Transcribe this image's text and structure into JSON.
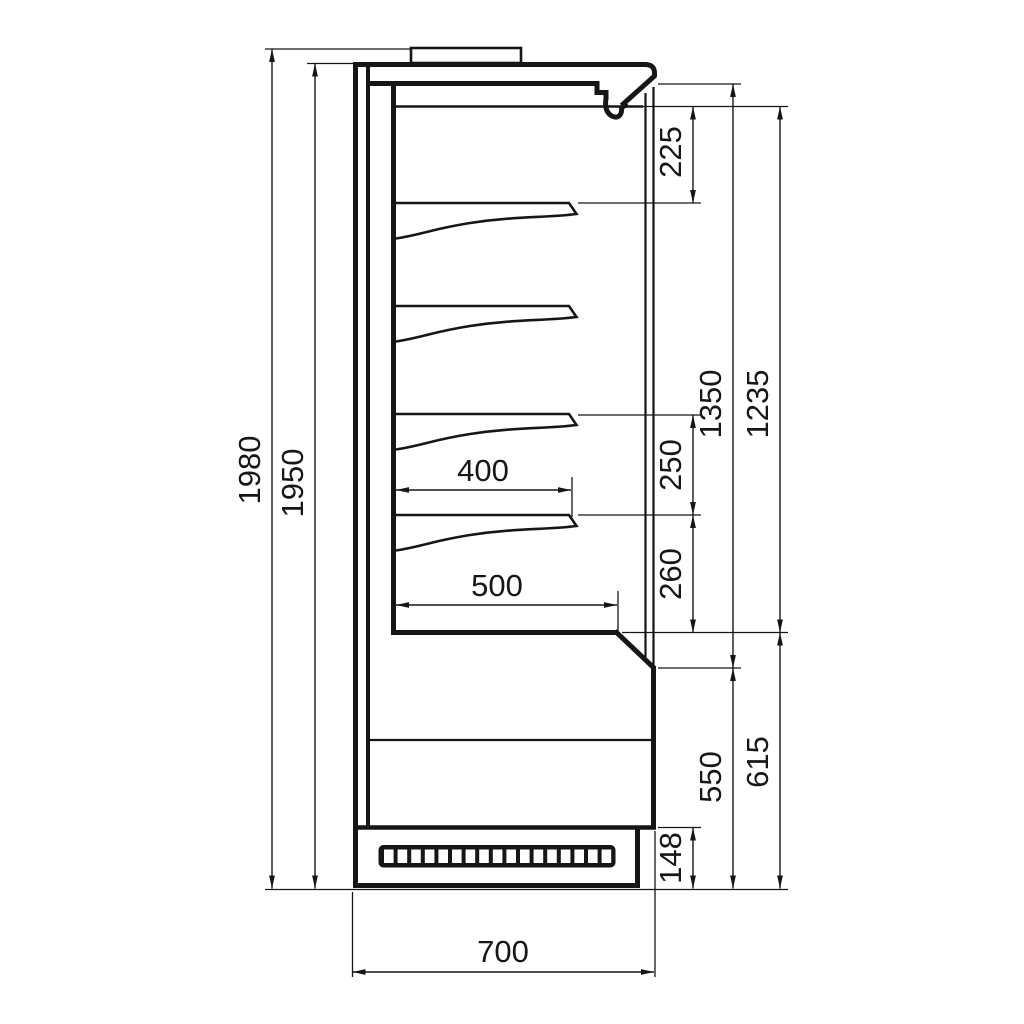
{
  "colors": {
    "ink": "#161616",
    "background": "#ffffff"
  },
  "dimensions": {
    "overall_height": "1980",
    "cabinet_height": "1950",
    "canopy_to_first_shelf": "225",
    "shelf_pitch_upper": "250",
    "shelf_pitch_lower": "260",
    "opening_height": "1350",
    "display_height": "1235",
    "shelf_depth": "400",
    "bottom_shelf_depth": "500",
    "base_section_height": "615",
    "base_front_height": "550",
    "plinth_height": "148",
    "overall_depth": "700"
  }
}
